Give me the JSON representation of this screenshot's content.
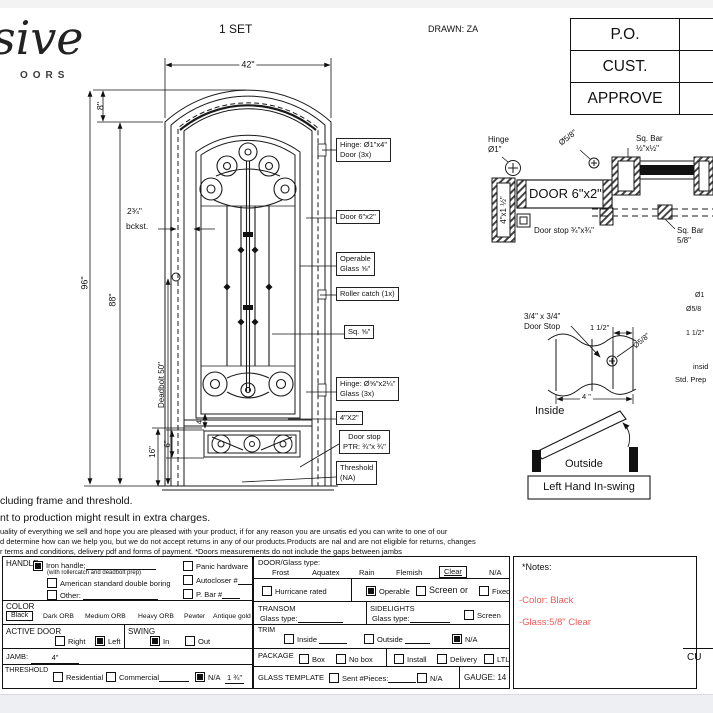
{
  "meta": {
    "set": "1 SET",
    "drawn": "DRAWN: ZA"
  },
  "logo": {
    "script": "sive",
    "sub": "OORS"
  },
  "approval": {
    "rows": [
      "P.O.",
      "CUST.",
      "APPROVE"
    ]
  },
  "dims": {
    "w42": "42\"",
    "h8": "8\"",
    "h96": "96\"",
    "h88": "88\"",
    "backset": "2¾\"",
    "backset_label": "bckst.",
    "deadbolt": "Deadbolt 50\"",
    "h16": "16\"",
    "h6": "6\"",
    "h4": "4\""
  },
  "callouts": {
    "hinge_door": "Hinge: Ø1\"x4\"\nDoor (3x)",
    "door_62": "Door 6\"x2\"",
    "operable": "Operable\nGlass ⅝\"",
    "roller": "Roller catch  (1x)",
    "sq": "Sq. ⅝\"",
    "hinge_glass": "Hinge: Ø⅝\"x2¼\"\nGlass (3x)",
    "kick": "4\"X2\"",
    "doorstop": "Door stop\nPTR: ¾\"x ¾\"",
    "threshold": "Threshold\n(NA)"
  },
  "detail_jamb": {
    "hinge": "Hinge\nØ1\"",
    "door": "DOOR 6\"x2\"",
    "jamb": "4\"x1 ½\"",
    "dia": "Ø5/8\"",
    "sqbar_half": "Sq. Bar\n½\"x½\"",
    "doorstop": "Door stop ¾\"x¾\"",
    "sqbar_58": "Sq. Bar\n5/8\""
  },
  "detail_stop": {
    "label": "3/4\" x 3/4\"\nDoor Stop",
    "dim_1half": "1 1/2\"",
    "dia": "Ø5/8\"",
    "dim_4": "4 \"",
    "edge_1": "Ø1",
    "edge_2": "Ø5/8",
    "edge_3": "1 1/2\"",
    "edge_4": "insid",
    "edge_5": "Std. Prep"
  },
  "swing_diagram": {
    "inside": "Inside",
    "outside": "Outside",
    "label": "Left Hand In-swing"
  },
  "disclaimer": {
    "line1": "cluding frame and threshold.",
    "line2": "nt to production might result in extra charges.",
    "line3": "uality of everything we sell and hope you are pleased with your product, if for any reason you are unsatis   ed you can write to one of our",
    "line4": "d determine how can we help you, but we do not accept returns in any of our products.Products are    nal and are not eligible for returns, changes",
    "line5": "r terms and conditions, delivery pdf and forms of payment. *Doors measurements do not include the gaps between jambs"
  },
  "form": {
    "handle": {
      "title": "HANDLE",
      "iron": "Iron handle;",
      "iron_checked": true,
      "iron_note": "(with rollercatch and deadbolt prep)",
      "boring": "American standard double boring",
      "boring_checked": false,
      "other": "Other:",
      "other_checked": false,
      "panic": "Panic hardware",
      "panic_checked": false,
      "autocloser": "Autocloser #",
      "autocloser_checked": false,
      "pbar": "P. Bar #",
      "pbar_checked": false
    },
    "color": {
      "title": "COLOR",
      "selected": "Black",
      "opt1": "Dark ORB",
      "opt2": "Medium ORB",
      "opt3": "Heavy ORB",
      "opt4": "Pewter",
      "opt5": "Antique gold"
    },
    "active": {
      "title": "ACTIVE DOOR",
      "right": "Right",
      "right_checked": false,
      "left": "Left",
      "left_checked": true
    },
    "swing": {
      "title": "SWING",
      "in": "In",
      "in_checked": true,
      "out": "Out",
      "out_checked": false
    },
    "jamb": {
      "title": "JAMB:",
      "value": "4\""
    },
    "threshold": {
      "title": "THRESHOLD",
      "residential": "Residential",
      "residential_checked": false,
      "commercial": "Commercial",
      "commercial_checked": false,
      "na": "N/A",
      "na_checked": true,
      "value": "1 ¾\""
    },
    "glass_type": {
      "title": "DOOR/Glass type:",
      "opt1": "Frost",
      "opt2": "Aquatex",
      "opt3": "Rain",
      "opt4": "Flemish",
      "selected": "Clear",
      "na": "N/A"
    },
    "hurricane": {
      "label": "Hurricane rated",
      "checked": false
    },
    "glazing": {
      "operable": "Operable",
      "operable_checked": true,
      "screen": "Screen or",
      "screen_checked": false,
      "fixed": "Fixed",
      "fixed_checked": false
    },
    "transom": {
      "title": "TRANSOM",
      "glass": "Glass type:"
    },
    "sidelights": {
      "title": "SIDELIGHTS",
      "glass": "Glass type:",
      "screen": "Screen",
      "screen_checked": false
    },
    "trim": {
      "title": "TRIM",
      "inside": "Inside",
      "inside_checked": false,
      "outside": "Outside",
      "outside_checked": false,
      "na": "N/A",
      "na_checked": true
    },
    "package": {
      "title": "PACKAGE",
      "box": "Box",
      "box_checked": false,
      "nobox": "No box",
      "nobox_checked": false,
      "install": "Install",
      "install_checked": false,
      "delivery": "Delivery",
      "delivery_checked": false,
      "ltl": "LTL",
      "ltl_checked": false
    },
    "template": {
      "title": "GLASS TEMPLATE",
      "sent": "Sent #Pieces:",
      "sent_checked": false,
      "na": "N/A",
      "na_checked": false
    },
    "gauge": "GAUGE: 14",
    "notes": {
      "title": "*Notes:",
      "line1": "-Color: Black",
      "line2": "-Glass:5/8\"  Clear"
    },
    "cust_partial": "CU"
  },
  "colors": {
    "red_note": "#e85c5c",
    "line": "#1a1a1a"
  }
}
